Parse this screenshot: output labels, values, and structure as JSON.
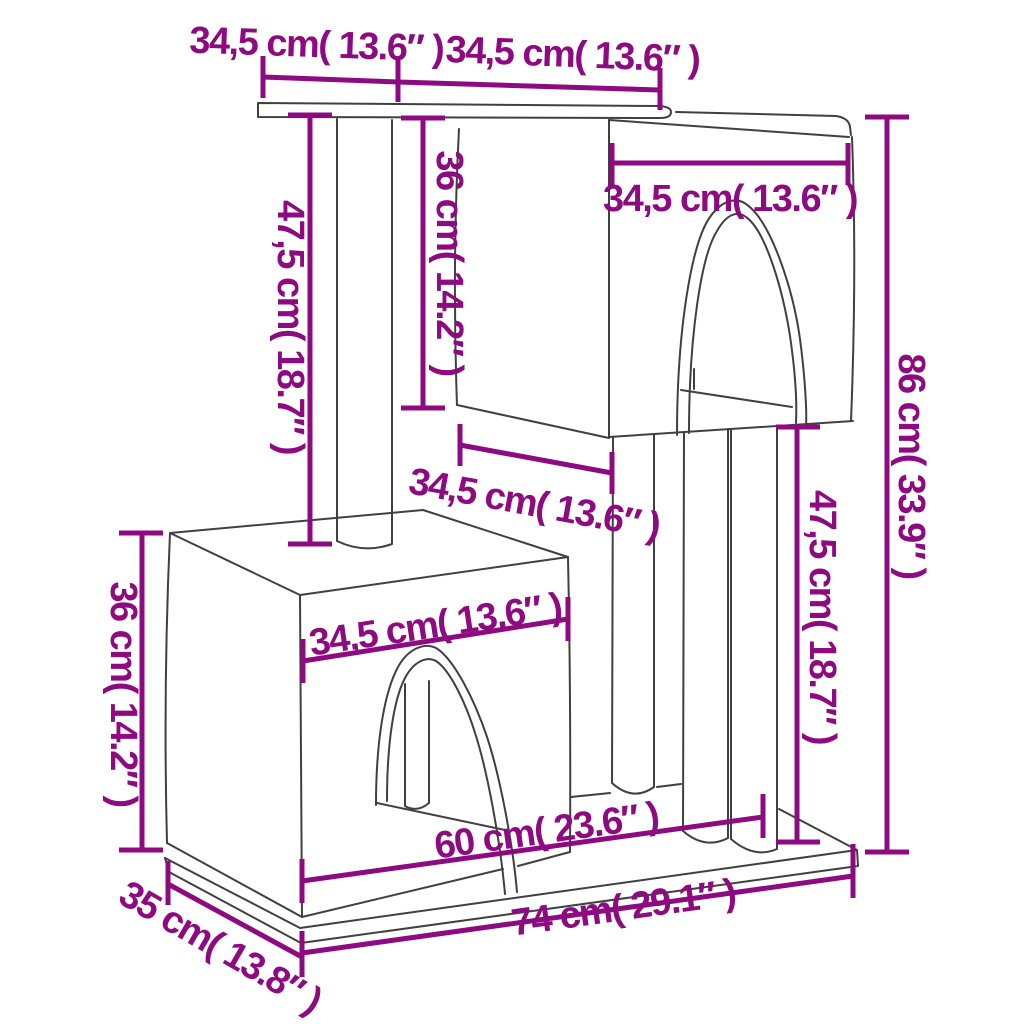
{
  "diagram": {
    "subject": "Cat tree with scratching posts and two condos - dimension drawing",
    "background_color": "#ffffff",
    "line_art_color": "#404040",
    "dimension_color": "#8E0A80",
    "dimensions": [
      {
        "id": "platform-width",
        "label": "34,5 cm( 13.6″ )"
      },
      {
        "id": "roof-width",
        "label": "34,5 cm( 13.6″ )"
      },
      {
        "id": "left-post-height",
        "label": "47,5 cm( 18.7″ )"
      },
      {
        "id": "upper-condo-height",
        "label": "36 cm( 14.2″ )"
      },
      {
        "id": "upper-condo-width",
        "label": "34,5 cm( 13.6″ )"
      },
      {
        "id": "upper-condo-depth",
        "label": "34,5 cm( 13.6″ )"
      },
      {
        "id": "total-height",
        "label": "86 cm( 33.9″ )"
      },
      {
        "id": "right-post-height",
        "label": "47,5 cm( 18.7″ )"
      },
      {
        "id": "lower-condo-height",
        "label": "36 cm( 14.2″ )"
      },
      {
        "id": "lower-condo-width",
        "label": "34,5 cm( 13.6″ )"
      },
      {
        "id": "inner-base-width",
        "label": "60 cm( 23.6″ )"
      },
      {
        "id": "base-width",
        "label": "74 cm( 29.1″ )"
      },
      {
        "id": "base-depth",
        "label": "35 cm( 13.8″ )"
      }
    ]
  }
}
